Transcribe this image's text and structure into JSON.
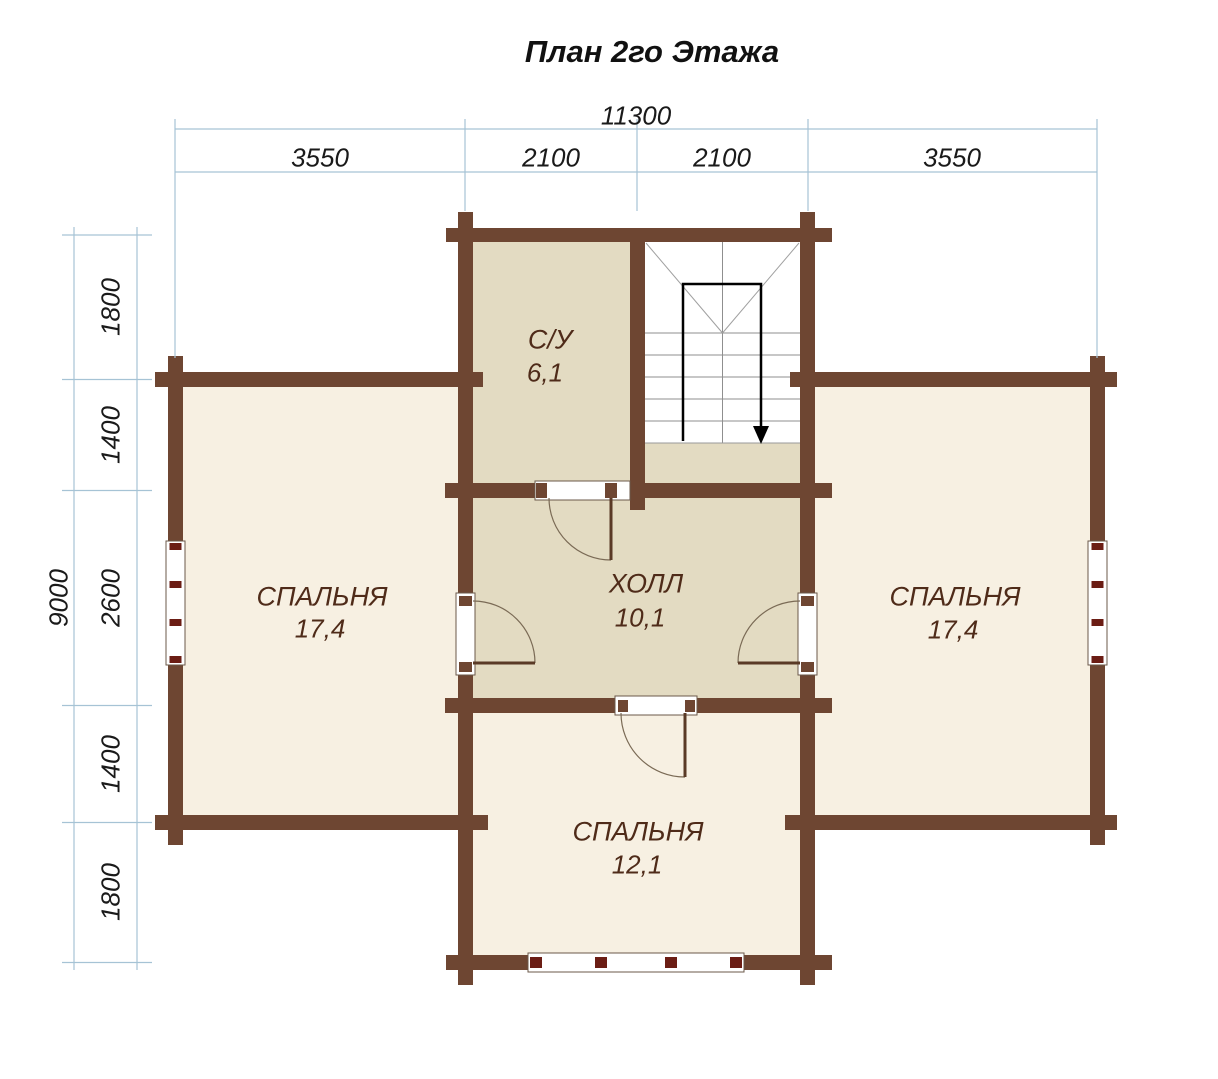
{
  "title": "План 2го Этажа",
  "dimensions": {
    "top": {
      "overall": "11300",
      "segments": [
        "3550",
        "2100",
        "2100",
        "3550"
      ]
    },
    "left": {
      "overall": "9000",
      "segments": [
        "1800",
        "1400",
        "2600",
        "1400",
        "1800"
      ]
    }
  },
  "rooms": [
    {
      "name": "С/У",
      "area": "6,1"
    },
    {
      "name": "ХОЛЛ",
      "area": "10,1"
    },
    {
      "name": "СПАЛЬНЯ",
      "area": "17,4"
    },
    {
      "name": "СПАЛЬНЯ",
      "area": "17,4"
    },
    {
      "name": "СПАЛЬНЯ",
      "area": "12,1"
    }
  ],
  "colors": {
    "wall_brown": "#6e4632",
    "room_light_fill": "#f7f0e2",
    "room_dark_fill": "#e3dbc2",
    "stairwell_fill": "#ffffff",
    "window_mullion_red": "#6b1d14",
    "dimension_line_blue": "#a6c3d5",
    "room_label_brown": "#4f2b19",
    "stair_route_black": "#000000"
  }
}
